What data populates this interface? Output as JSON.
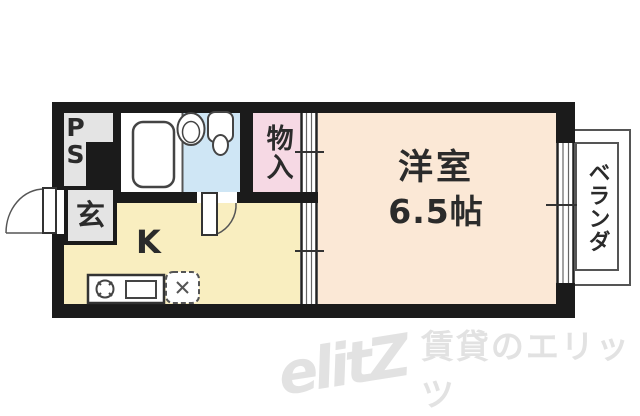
{
  "floor_plan": {
    "ps": {
      "line1": "P",
      "line2": "S"
    },
    "genkan": {
      "label": "玄"
    },
    "kitchen": {
      "label": "K"
    },
    "storage": {
      "label": "物入"
    },
    "western_room": {
      "label": "洋室",
      "size": "6.5帖"
    },
    "veranda": {
      "label": "ベランダ"
    },
    "colors": {
      "wall": "#1b1b1b",
      "western_room_fill": "#fbe8d6",
      "kitchen_fill": "#f9eec0",
      "toilet_fill": "#cfe6f5",
      "storage_fill": "#f6d9e4",
      "service_gray": "#e4e4e4",
      "fixture_line": "#444444"
    }
  },
  "watermark": {
    "logo": "elitZ",
    "text": "賃貸のエリッツ"
  }
}
